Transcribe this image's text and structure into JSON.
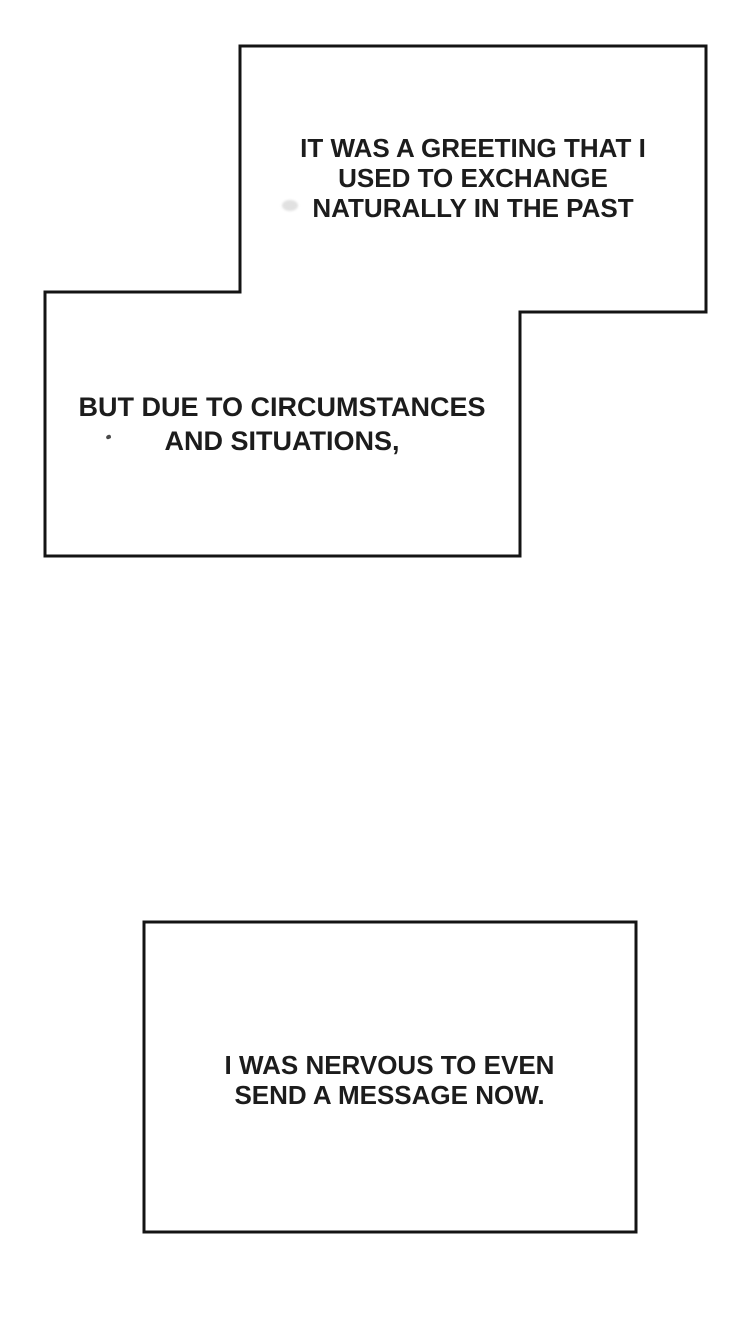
{
  "page": {
    "background_color": "#ffffff",
    "outline_color": "#141414",
    "text_color": "#1c1c1c"
  },
  "captions": {
    "top": {
      "lines": [
        "IT WAS A GREETING THAT I",
        "USED TO EXCHANGE",
        "NATURALLY IN THE PAST"
      ]
    },
    "middle": {
      "lines": [
        "BUT DUE TO CIRCUMSTANCES",
        "AND SITUATIONS,"
      ]
    },
    "bottom": {
      "lines": [
        "I WAS NERVOUS TO EVEN",
        "SEND A MESSAGE NOW."
      ]
    }
  }
}
